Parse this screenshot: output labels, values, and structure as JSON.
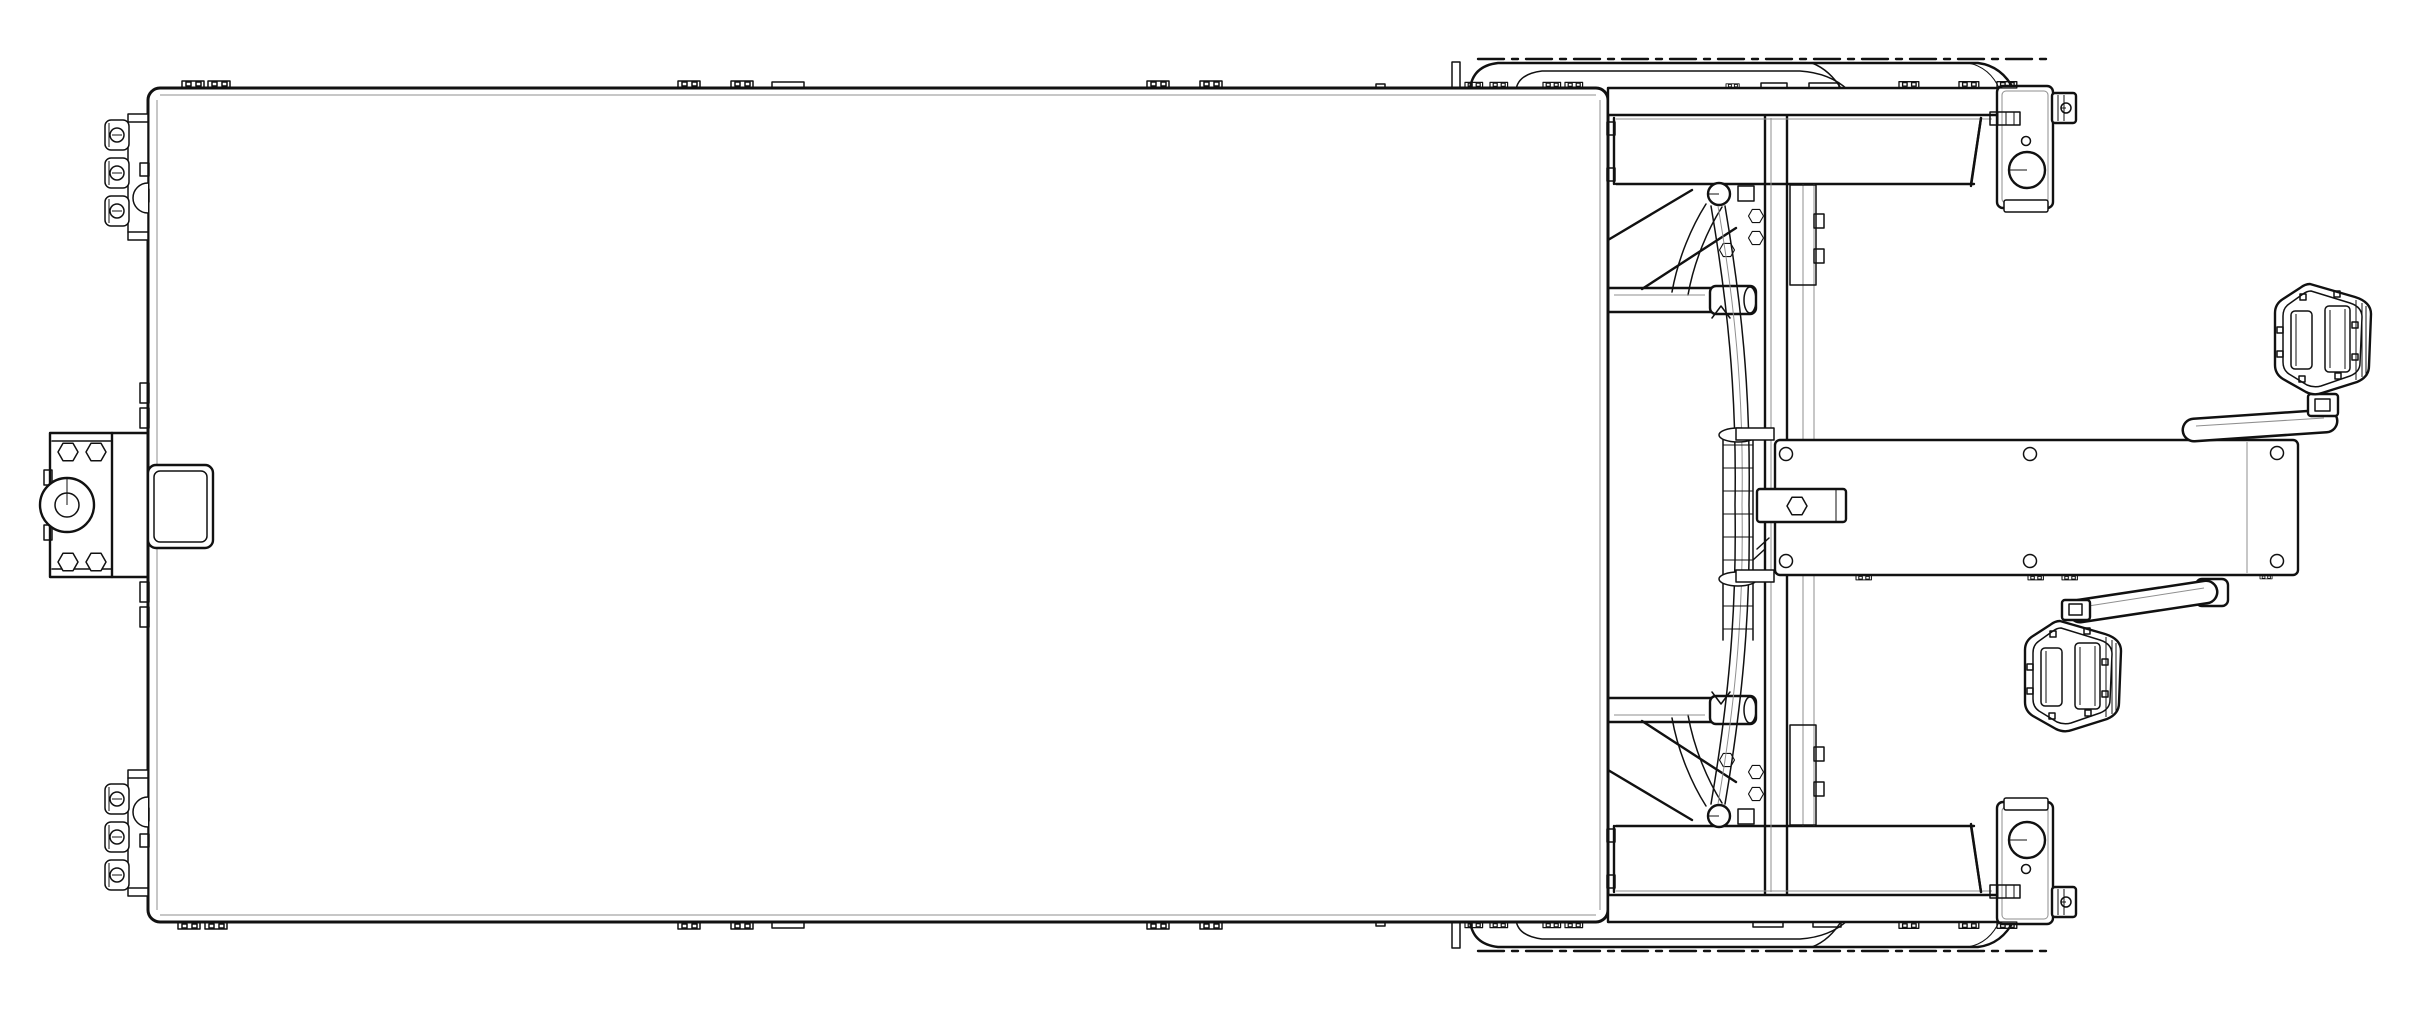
{
  "drawing": {
    "type": "technical-line-drawing",
    "view": "top view",
    "subject": "Pedal-powered flatbed cargo trike assembly",
    "background": "#ffffff",
    "line_color": "#111111",
    "thin_line_color": "#8f8f8f"
  },
  "parts": {
    "platform": "cargo platform bed",
    "hitch": "front tow hitch",
    "hitch_ring": "hitch eye ring",
    "hitch_plate": "hitch bolt plate",
    "hitch_block": "hitch mounting block",
    "edge_clamps": "platform edge clamp cluster",
    "edge_tabs": "platform edge fastener tabs",
    "fender_top": "wheel fender (near side)",
    "fender_bottom": "wheel fender (far side)",
    "side_beam_top": "side beam (near side)",
    "side_beam_bottom": "side beam (far side)",
    "bracket_top": "axle bracket with reflector (near side)",
    "bracket_bottom": "axle bracket with reflector (far side)",
    "axle_stub": "axle stub",
    "wheel_well": "wheel well",
    "frame": "steering / drive frame",
    "cross_tube": "frame cross tube",
    "column": "steering column",
    "chain_ladder": "drive chain run",
    "steer_tube": "curved steering tube",
    "boom": "drive boom",
    "tongue": "boom mounting tongue",
    "crank_top": "crank arm (near side)",
    "crank_bottom": "crank arm (far side)",
    "pedal_top": "pedal (near side)",
    "pedal_bottom": "pedal (far side)",
    "mast": "edge mast pin"
  }
}
